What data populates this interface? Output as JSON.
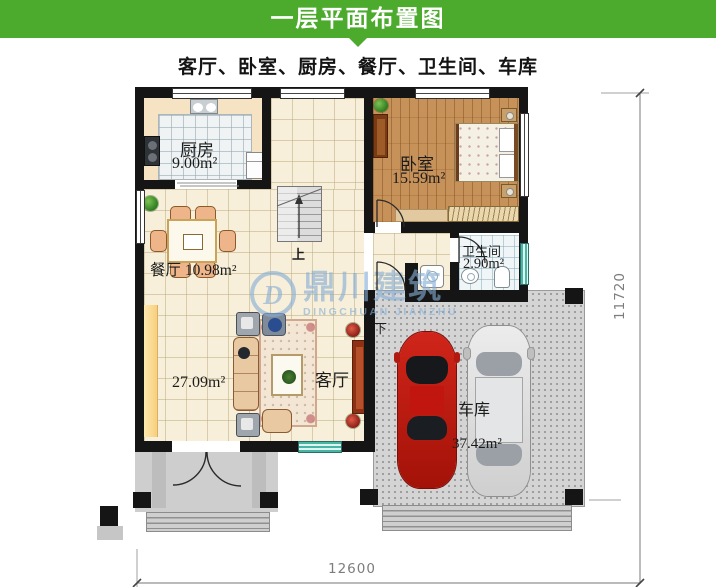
{
  "header": {
    "title": "一层平面布置图",
    "subtitle": "客厅、卧室、厨房、餐厅、卫生间、车库",
    "accent_color": "#4caa2d"
  },
  "plan": {
    "rooms": {
      "kitchen": {
        "name": "厨房",
        "area": "9.00m²"
      },
      "bedroom": {
        "name": "卧室",
        "area": "15.59m²"
      },
      "dining": {
        "name": "餐厅",
        "area": "10.98m²"
      },
      "bathroom": {
        "name": "卫生间",
        "area": "2.90m²"
      },
      "living": {
        "name": "客厅",
        "area": "27.09m²"
      },
      "garage": {
        "name": "车库",
        "area": "37.42m²"
      }
    },
    "stairs": {
      "up": "上",
      "down": "下"
    },
    "dimensions": {
      "width_mm": "12600",
      "height_mm": "11720"
    }
  },
  "watermark": {
    "logo": "D",
    "cn": "鼎川建筑",
    "en": "DINGCHUAN JIANZHU"
  }
}
